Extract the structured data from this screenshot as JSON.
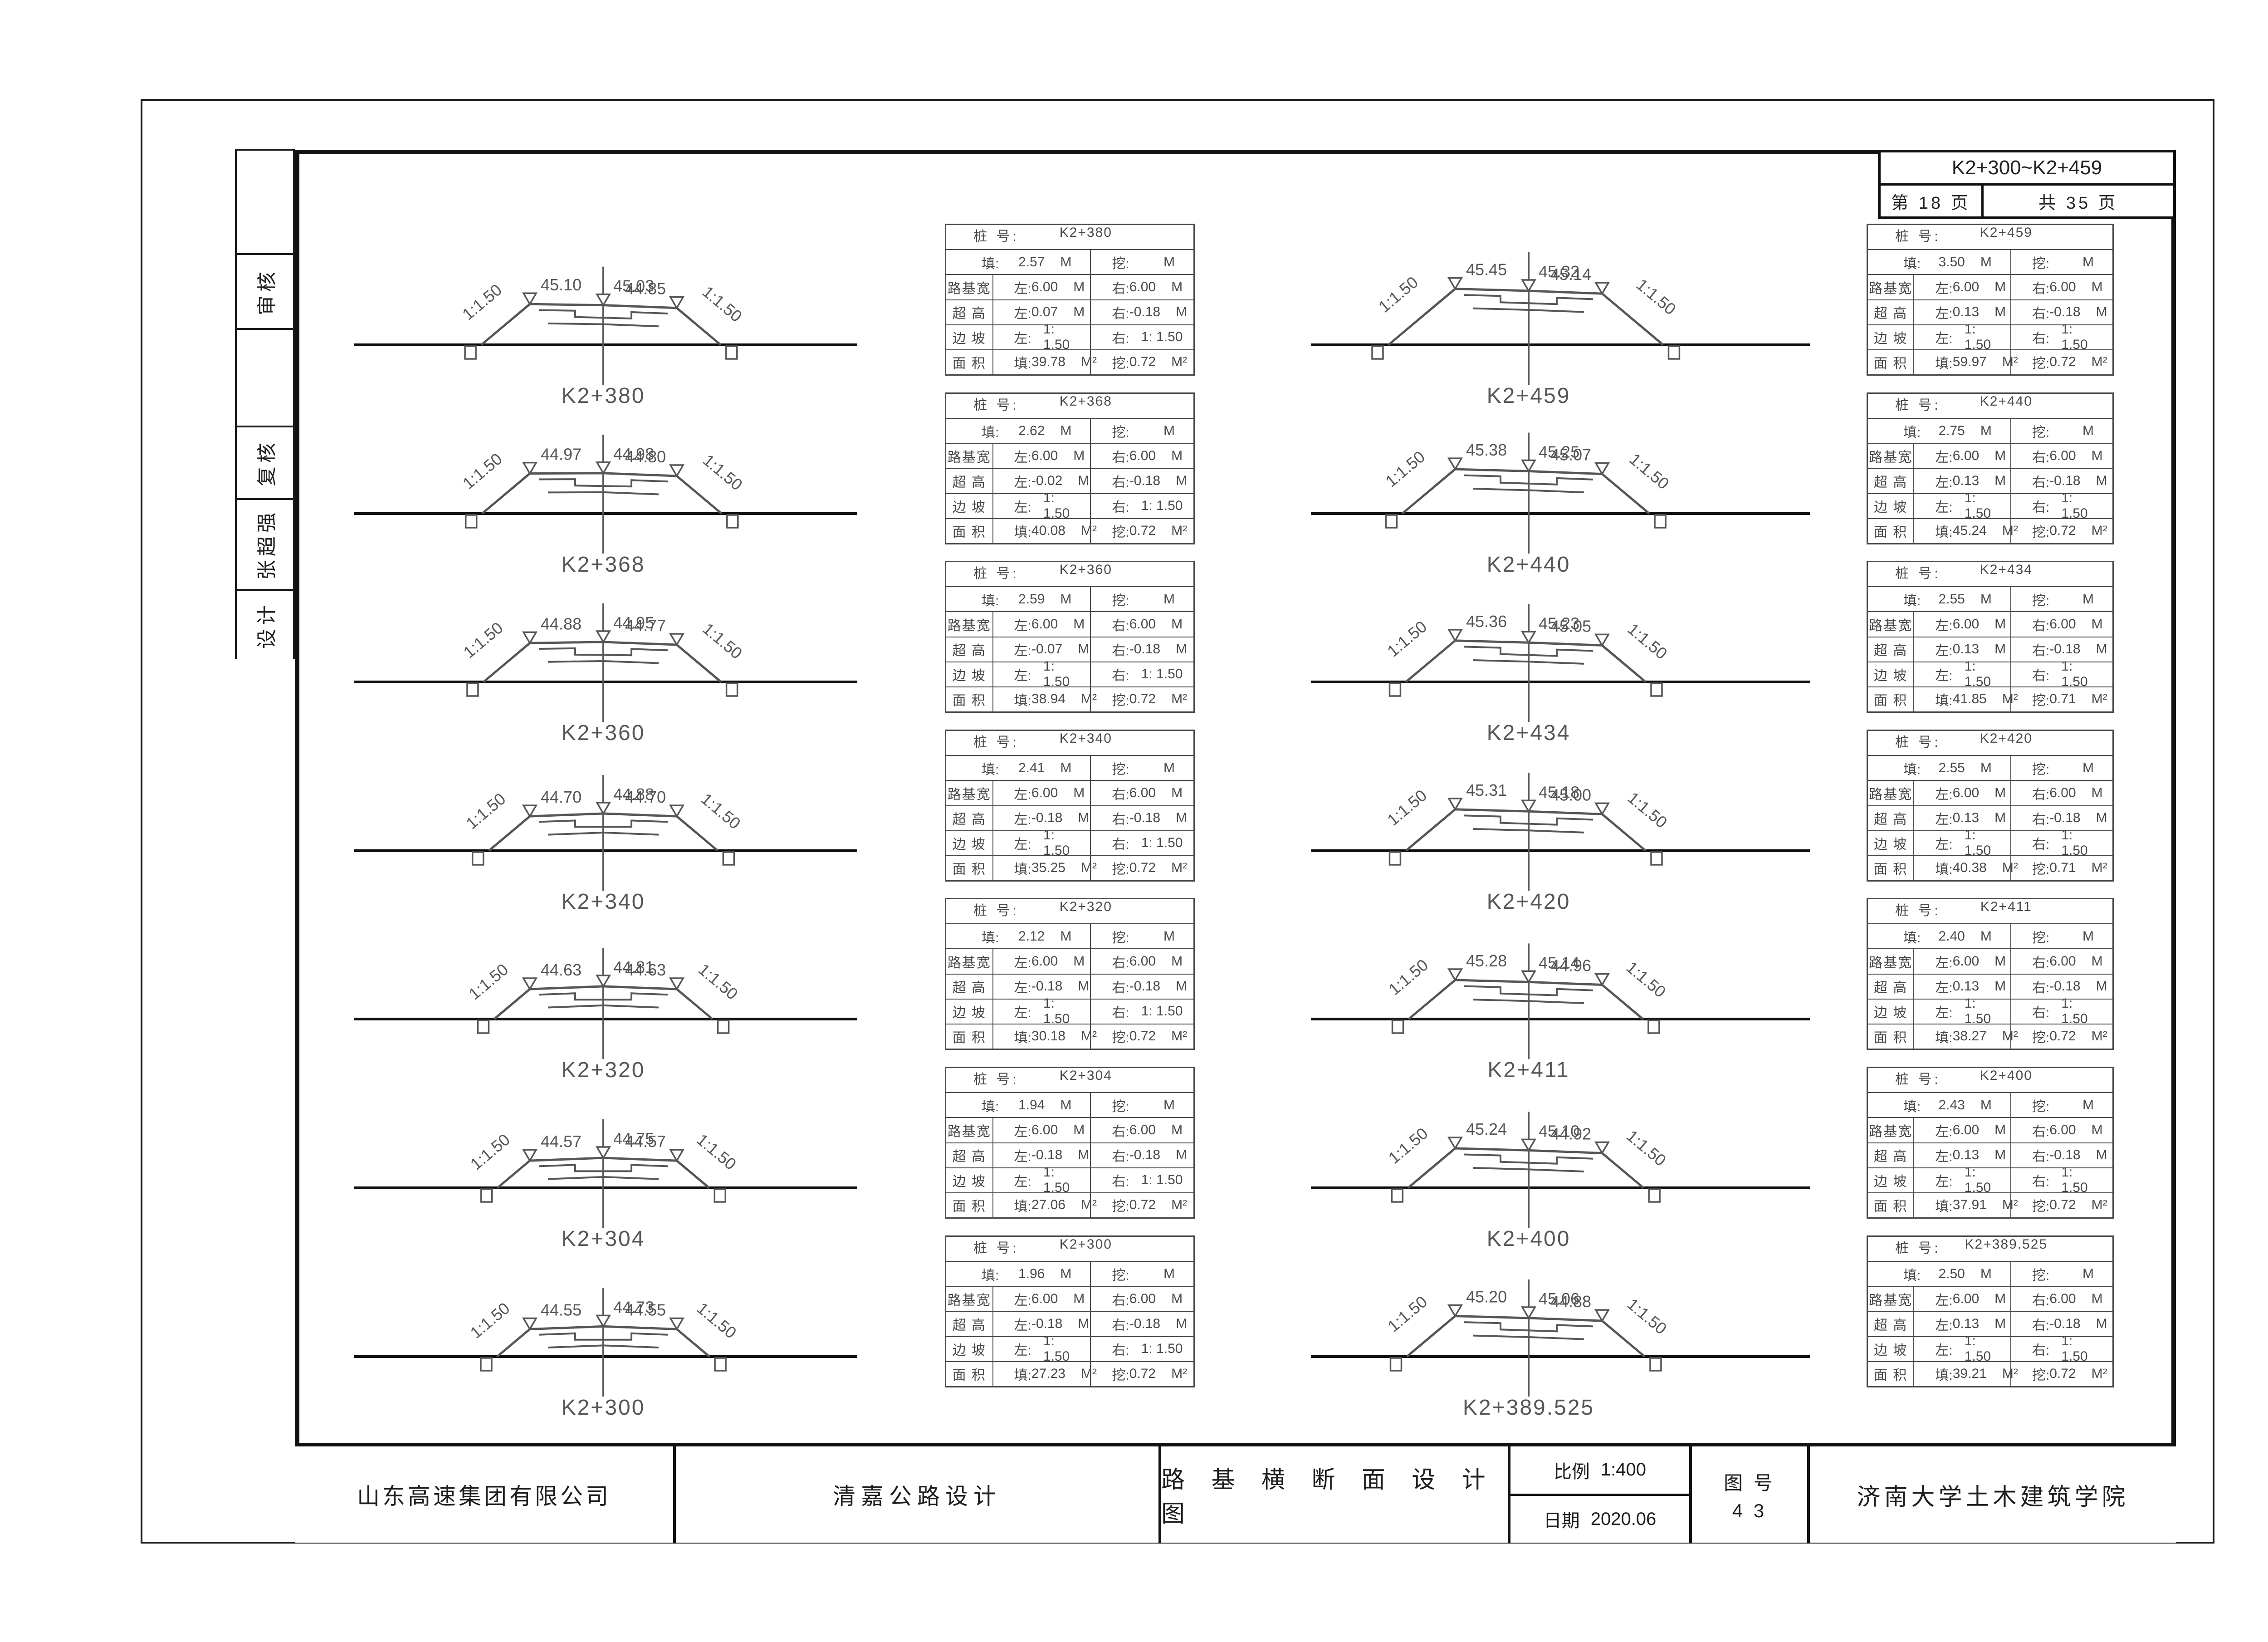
{
  "sheet": {
    "range_label": "K2+300~K2+459",
    "page_label": "第  18  页",
    "total_label": "共  35  页"
  },
  "margin_boxes": [
    "",
    "审核",
    "",
    "复核",
    "张超强",
    "设计"
  ],
  "title_block": {
    "company": "山东高速集团有限公司",
    "project": "清嘉公路设计",
    "drawing_title": "路 基 横 断 面 设 计 图",
    "scale_label": "比例",
    "scale_value": "1:400",
    "date_label": "日期",
    "date_value": "2020.06",
    "fig_no_label": "图 号",
    "fig_no_value": "4 3",
    "institute": "济南大学土木建筑学院"
  },
  "table_labels": {
    "station": "桩  号:",
    "fill": "填:",
    "cut": "挖:",
    "roadbed_width": "路基宽",
    "superelevation": "超  高",
    "side_slope": "边  坡",
    "area": "面  积",
    "left": "左:",
    "right": "右:",
    "unit_m": "M",
    "unit_m2": "M²"
  },
  "diagram_labels": {
    "slope_left": "1:1.50",
    "slope_right": "1:1.50"
  },
  "columns": {
    "left": [
      {
        "station": "K2+380",
        "fill_m": "2.57",
        "cut_m": "",
        "width_left": "6.00",
        "width_right": "6.00",
        "se_left": "0.07",
        "se_right": "-0.18",
        "slope_left": "1: 1.50",
        "slope_right": "1: 1.50",
        "area_fill": "39.78",
        "area_cut": "0.72",
        "elev_left": "45.10",
        "elev_center": "45.03",
        "elev_right": "44.85"
      },
      {
        "station": "K2+368",
        "fill_m": "2.62",
        "cut_m": "",
        "width_left": "6.00",
        "width_right": "6.00",
        "se_left": "-0.02",
        "se_right": "-0.18",
        "slope_left": "1: 1.50",
        "slope_right": "1: 1.50",
        "area_fill": "40.08",
        "area_cut": "0.72",
        "elev_left": "44.97",
        "elev_center": "44.98",
        "elev_right": "44.80"
      },
      {
        "station": "K2+360",
        "fill_m": "2.59",
        "cut_m": "",
        "width_left": "6.00",
        "width_right": "6.00",
        "se_left": "-0.07",
        "se_right": "-0.18",
        "slope_left": "1: 1.50",
        "slope_right": "1: 1.50",
        "area_fill": "38.94",
        "area_cut": "0.72",
        "elev_left": "44.88",
        "elev_center": "44.95",
        "elev_right": "44.77"
      },
      {
        "station": "K2+340",
        "fill_m": "2.41",
        "cut_m": "",
        "width_left": "6.00",
        "width_right": "6.00",
        "se_left": "-0.18",
        "se_right": "-0.18",
        "slope_left": "1: 1.50",
        "slope_right": "1: 1.50",
        "area_fill": "35.25",
        "area_cut": "0.72",
        "elev_left": "44.70",
        "elev_center": "44.88",
        "elev_right": "44.70"
      },
      {
        "station": "K2+320",
        "fill_m": "2.12",
        "cut_m": "",
        "width_left": "6.00",
        "width_right": "6.00",
        "se_left": "-0.18",
        "se_right": "-0.18",
        "slope_left": "1: 1.50",
        "slope_right": "1: 1.50",
        "area_fill": "30.18",
        "area_cut": "0.72",
        "elev_left": "44.63",
        "elev_center": "44.81",
        "elev_right": "44.63"
      },
      {
        "station": "K2+304",
        "fill_m": "1.94",
        "cut_m": "",
        "width_left": "6.00",
        "width_right": "6.00",
        "se_left": "-0.18",
        "se_right": "-0.18",
        "slope_left": "1: 1.50",
        "slope_right": "1: 1.50",
        "area_fill": "27.06",
        "area_cut": "0.72",
        "elev_left": "44.57",
        "elev_center": "44.75",
        "elev_right": "44.57"
      },
      {
        "station": "K2+300",
        "fill_m": "1.96",
        "cut_m": "",
        "width_left": "6.00",
        "width_right": "6.00",
        "se_left": "-0.18",
        "se_right": "-0.18",
        "slope_left": "1: 1.50",
        "slope_right": "1: 1.50",
        "area_fill": "27.23",
        "area_cut": "0.72",
        "elev_left": "44.55",
        "elev_center": "44.73",
        "elev_right": "44.55"
      }
    ],
    "right": [
      {
        "station": "K2+459",
        "fill_m": "3.50",
        "cut_m": "",
        "width_left": "6.00",
        "width_right": "6.00",
        "se_left": "0.13",
        "se_right": "-0.18",
        "slope_left": "1: 1.50",
        "slope_right": "1: 1.50",
        "area_fill": "59.97",
        "area_cut": "0.72",
        "elev_left": "45.45",
        "elev_center": "45.32",
        "elev_right": "45.14"
      },
      {
        "station": "K2+440",
        "fill_m": "2.75",
        "cut_m": "",
        "width_left": "6.00",
        "width_right": "6.00",
        "se_left": "0.13",
        "se_right": "-0.18",
        "slope_left": "1: 1.50",
        "slope_right": "1: 1.50",
        "area_fill": "45.24",
        "area_cut": "0.72",
        "elev_left": "45.38",
        "elev_center": "45.25",
        "elev_right": "45.07"
      },
      {
        "station": "K2+434",
        "fill_m": "2.55",
        "cut_m": "",
        "width_left": "6.00",
        "width_right": "6.00",
        "se_left": "0.13",
        "se_right": "-0.18",
        "slope_left": "1: 1.50",
        "slope_right": "1: 1.50",
        "area_fill": "41.85",
        "area_cut": "0.71",
        "elev_left": "45.36",
        "elev_center": "45.23",
        "elev_right": "45.05"
      },
      {
        "station": "K2+420",
        "fill_m": "2.55",
        "cut_m": "",
        "width_left": "6.00",
        "width_right": "6.00",
        "se_left": "0.13",
        "se_right": "-0.18",
        "slope_left": "1: 1.50",
        "slope_right": "1: 1.50",
        "area_fill": "40.38",
        "area_cut": "0.71",
        "elev_left": "45.31",
        "elev_center": "45.18",
        "elev_right": "45.00"
      },
      {
        "station": "K2+411",
        "fill_m": "2.40",
        "cut_m": "",
        "width_left": "6.00",
        "width_right": "6.00",
        "se_left": "0.13",
        "se_right": "-0.18",
        "slope_left": "1: 1.50",
        "slope_right": "1: 1.50",
        "area_fill": "38.27",
        "area_cut": "0.72",
        "elev_left": "45.28",
        "elev_center": "45.14",
        "elev_right": "44.96"
      },
      {
        "station": "K2+400",
        "fill_m": "2.43",
        "cut_m": "",
        "width_left": "6.00",
        "width_right": "6.00",
        "se_left": "0.13",
        "se_right": "-0.18",
        "slope_left": "1: 1.50",
        "slope_right": "1: 1.50",
        "area_fill": "37.91",
        "area_cut": "0.72",
        "elev_left": "45.24",
        "elev_center": "45.10",
        "elev_right": "44.92"
      },
      {
        "station": "K2+389.525",
        "fill_m": "2.50",
        "cut_m": "",
        "width_left": "6.00",
        "width_right": "6.00",
        "se_left": "0.13",
        "se_right": "-0.18",
        "slope_left": "1: 1.50",
        "slope_right": "1: 1.50",
        "area_fill": "39.21",
        "area_cut": "0.72",
        "elev_left": "45.20",
        "elev_center": "45.06",
        "elev_right": "44.88"
      }
    ]
  }
}
